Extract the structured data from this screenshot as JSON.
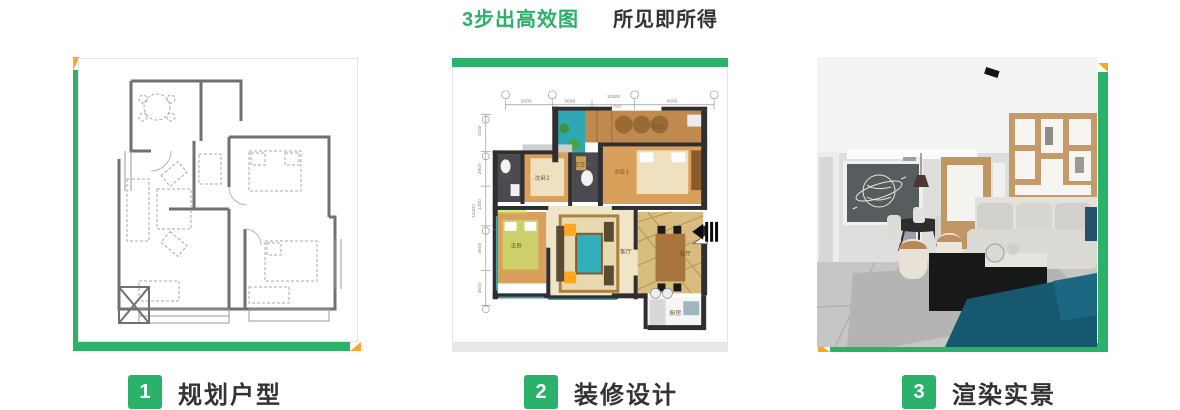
{
  "header": {
    "title_highlight": "3步出高效图",
    "title_rest": "所见即所得"
  },
  "colors": {
    "green": "#2BB169",
    "orange": "#F9A825",
    "label_text": "#333333",
    "card_border": "#e4e4e4"
  },
  "steps": [
    {
      "number": "1",
      "label": "规划户型"
    },
    {
      "number": "2",
      "label": "装修设计"
    },
    {
      "number": "3",
      "label": "渲染实景"
    }
  ],
  "floorplan": {
    "rooms": {
      "balcony": "阳台",
      "bedroom1": "次卧1",
      "bedroom2": "次卧2",
      "master": "主卧",
      "living": "客厅",
      "dining": "餐厅",
      "kitchen": "厨房",
      "bath1": "卫生间",
      "bath2": "卫生间"
    },
    "dims_top": {
      "total": "11800",
      "segments": [
        "2000",
        "3600",
        "1700",
        "4500"
      ]
    },
    "dims_left": {
      "total": "12400",
      "segments": [
        "1500",
        "2900",
        "1300",
        "3600",
        "3500"
      ]
    }
  }
}
